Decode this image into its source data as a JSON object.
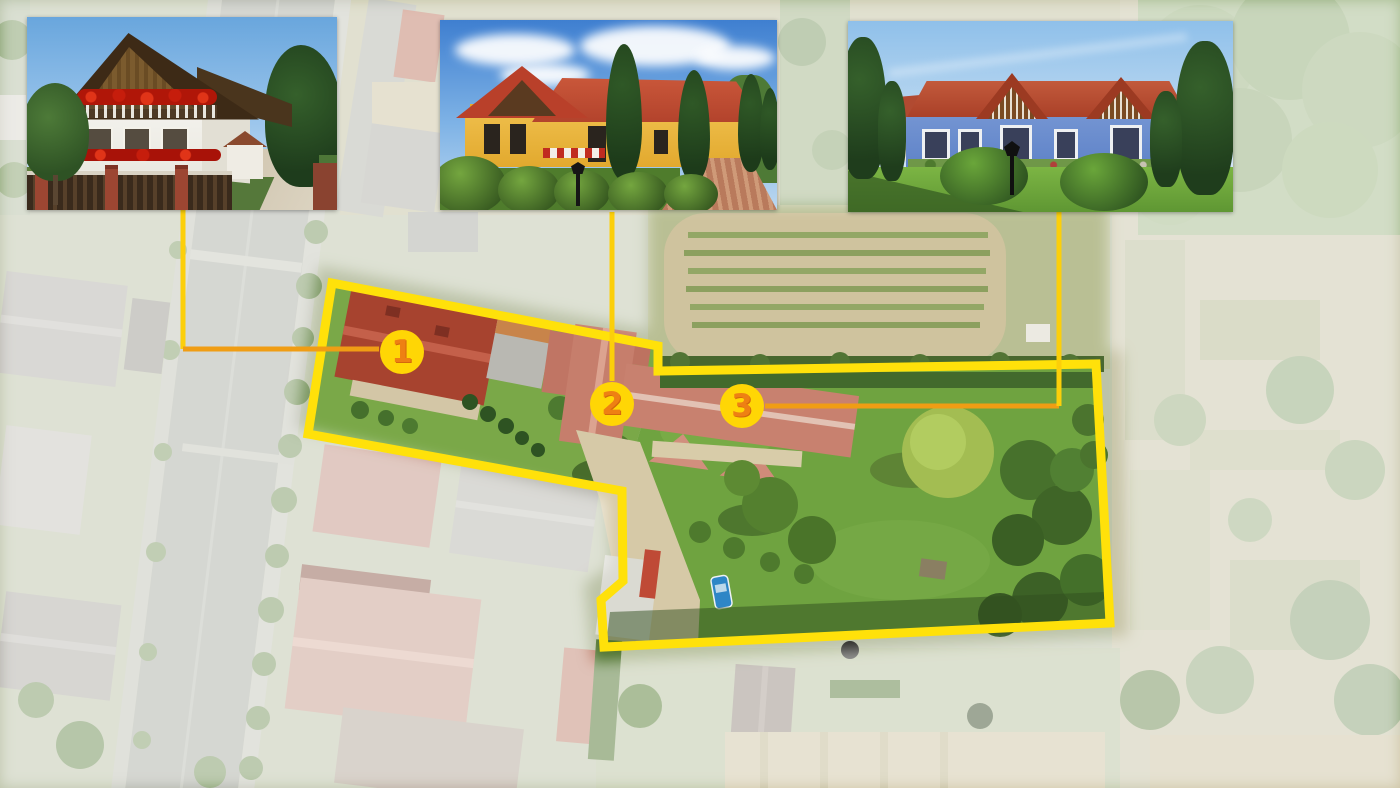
{
  "markers": [
    {
      "label": "1"
    },
    {
      "label": "2"
    },
    {
      "label": "3"
    }
  ],
  "insets": [
    {
      "name": "white-guesthouse-photo"
    },
    {
      "name": "yellow-cottage-photo"
    },
    {
      "name": "blue-bungalow-photo"
    }
  ],
  "palette": {
    "boundary_yellow": "#ffe10a",
    "connector_v": "#fccf0a",
    "connector_h": "#f09d14",
    "marker_fill": "#ffd605",
    "marker_number": "#ee8013"
  }
}
